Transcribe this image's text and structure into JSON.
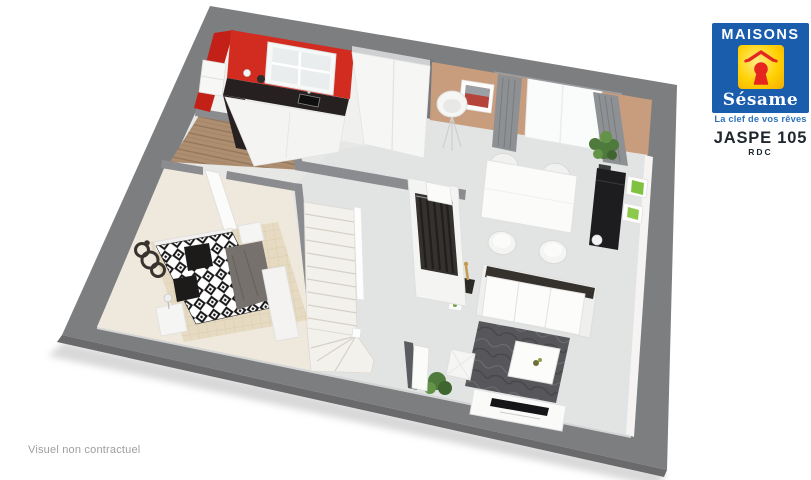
{
  "branding": {
    "logo": {
      "name_top": "MAISONS",
      "name_bottom": "Sésame",
      "tagline": "La clef de vos rêves",
      "colors": {
        "blue": "#1a5dad",
        "yellow": "#ffd103",
        "keyhole_red": "#e5261f"
      }
    },
    "model": {
      "name": "JASPE 105",
      "level": "RDC"
    }
  },
  "footer": {
    "disclaimer": "Visuel non contractuel"
  },
  "floorplan": {
    "view": "3d-isometric-ground-floor-plan",
    "rooms": [
      "kitchen",
      "living-dining-room",
      "entrance-hall",
      "bedroom",
      "staircase",
      "wardrobe-closet"
    ],
    "furniture": [
      "kitchen-counter-with-sink",
      "kitchen-window",
      "tall-white-cabinet",
      "wall-shelf",
      "dining-table",
      "dining-chairs-x4",
      "black-sideboard",
      "green-picture-frames",
      "floor-lamp",
      "window-with-gray-curtains",
      "wall-picture",
      "plants",
      "white-sofa",
      "side-table-with-gold-lamp",
      "dark-rug",
      "coffee-table",
      "tv-bench-with-tv",
      "white-pouf",
      "double-bed-diamond-duvet",
      "pillows",
      "gray-throw",
      "nightstands",
      "bedside-lamp",
      "ring-wall-art",
      "open-closet-clothes",
      "doors"
    ],
    "colors": {
      "base": "#7d7e80",
      "base_edge": "#6a6a6d",
      "floor": "#e7e7e6",
      "sejour_floor": "#e2e3e3",
      "kitchen_floor": "#f0f0ef",
      "bedroom_floor": "#efe8dd",
      "red_wall": "#d22b20",
      "red_wall_side": "#c32017",
      "beige_wall": "#c89d7d",
      "counter_black": "#262120",
      "curtain_gray": "#8e9194",
      "rug_gray": "#57575b",
      "sideboard_black": "#1d1d1f",
      "throw_gray": "#76716c",
      "plant_green": "#4e7a3c",
      "frame_green": "#7fc241",
      "wall_gray": "#8b8c8f",
      "stair_cream": "#f3f1ec"
    }
  }
}
